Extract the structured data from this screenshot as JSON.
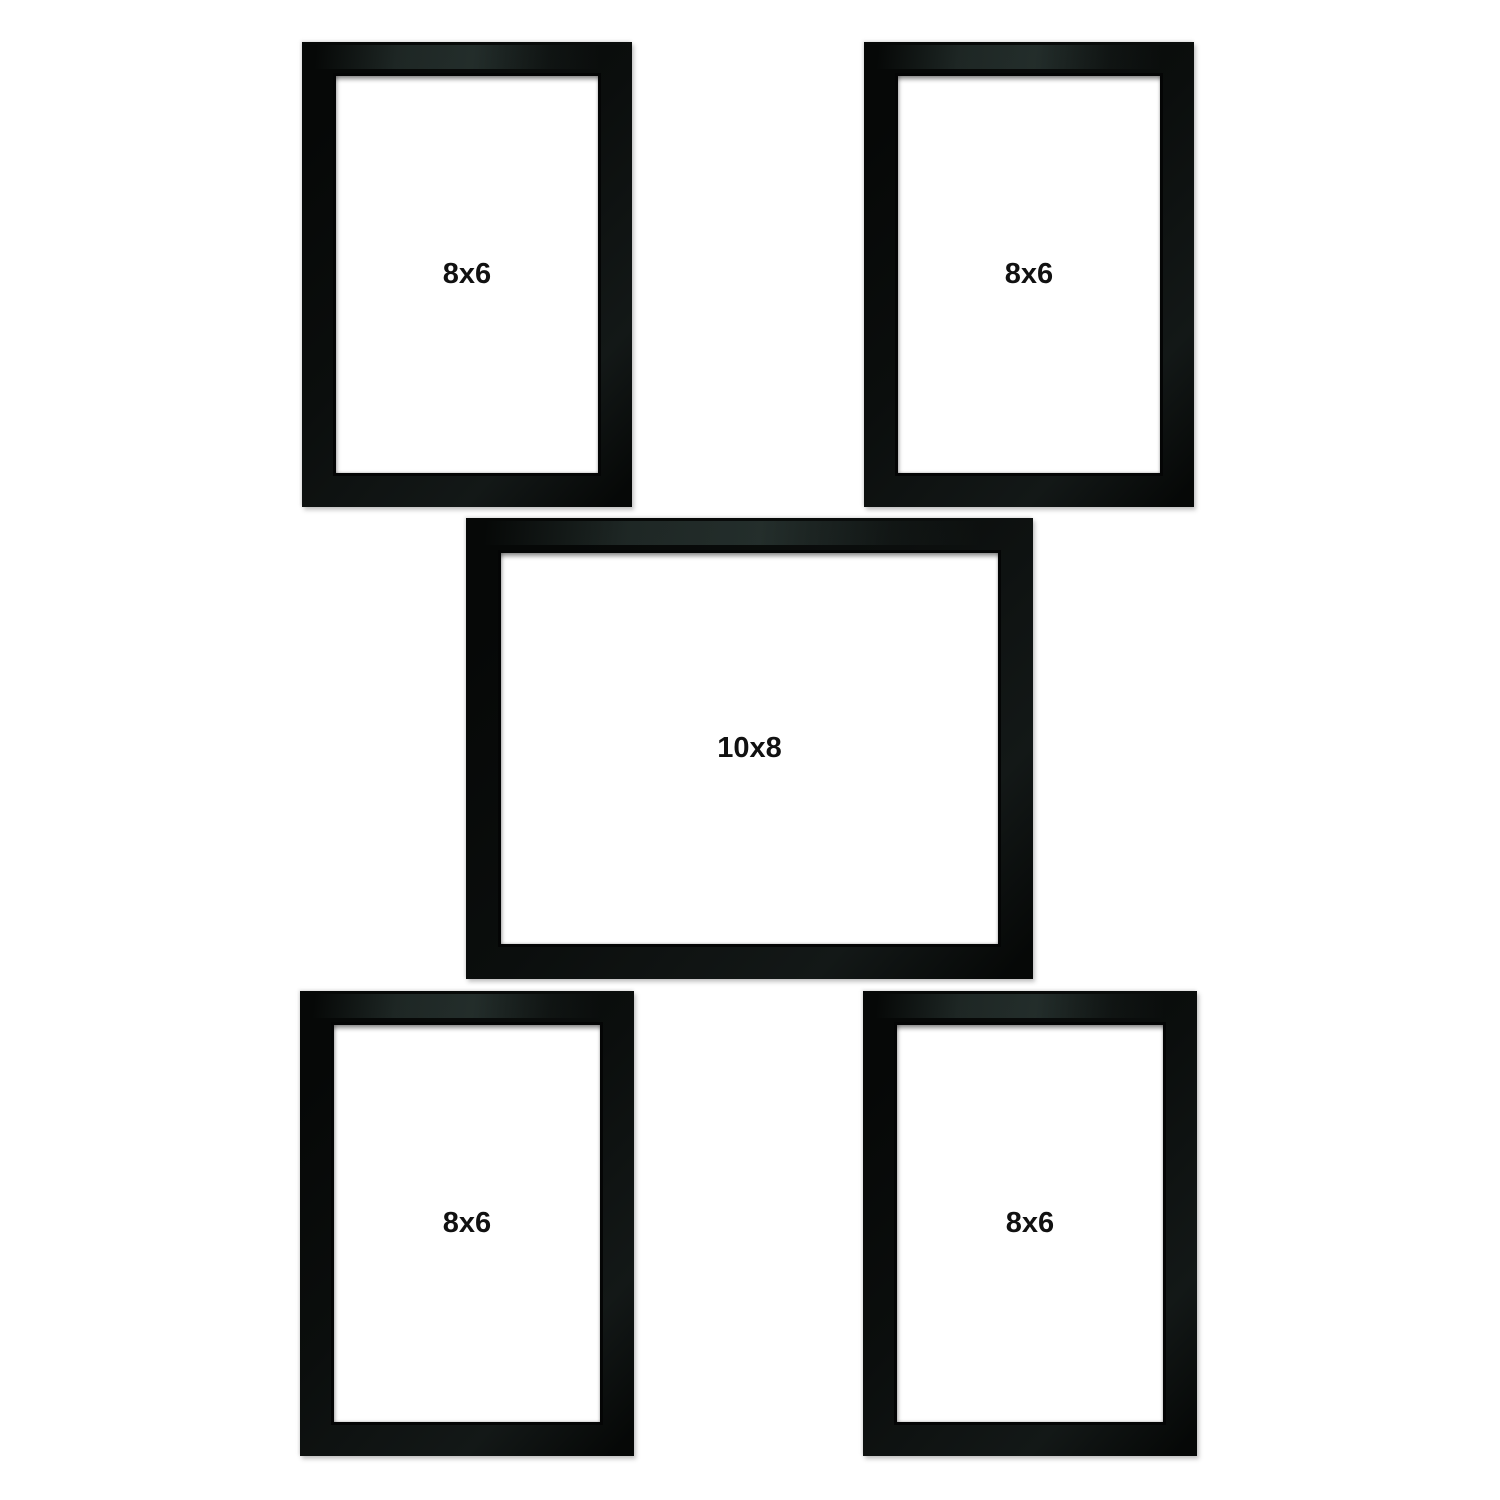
{
  "canvas": {
    "width": 1500,
    "height": 1500,
    "background_color": "#ffffff"
  },
  "product": {
    "description": "Set of five black photo frames arranged on a white background",
    "frame_finish_color": "#0a0c0c",
    "gloss_tint_color": "#3e504c",
    "aperture_color": "#ffffff",
    "label_color": "#111111"
  },
  "frames": [
    {
      "id": "top-left",
      "label": "8x6",
      "orientation": "portrait"
    },
    {
      "id": "top-right",
      "label": "8x6",
      "orientation": "portrait"
    },
    {
      "id": "middle",
      "label": "10x8",
      "orientation": "landscape"
    },
    {
      "id": "bottom-left",
      "label": "8x6",
      "orientation": "portrait"
    },
    {
      "id": "bottom-right",
      "label": "8x6",
      "orientation": "portrait"
    }
  ]
}
